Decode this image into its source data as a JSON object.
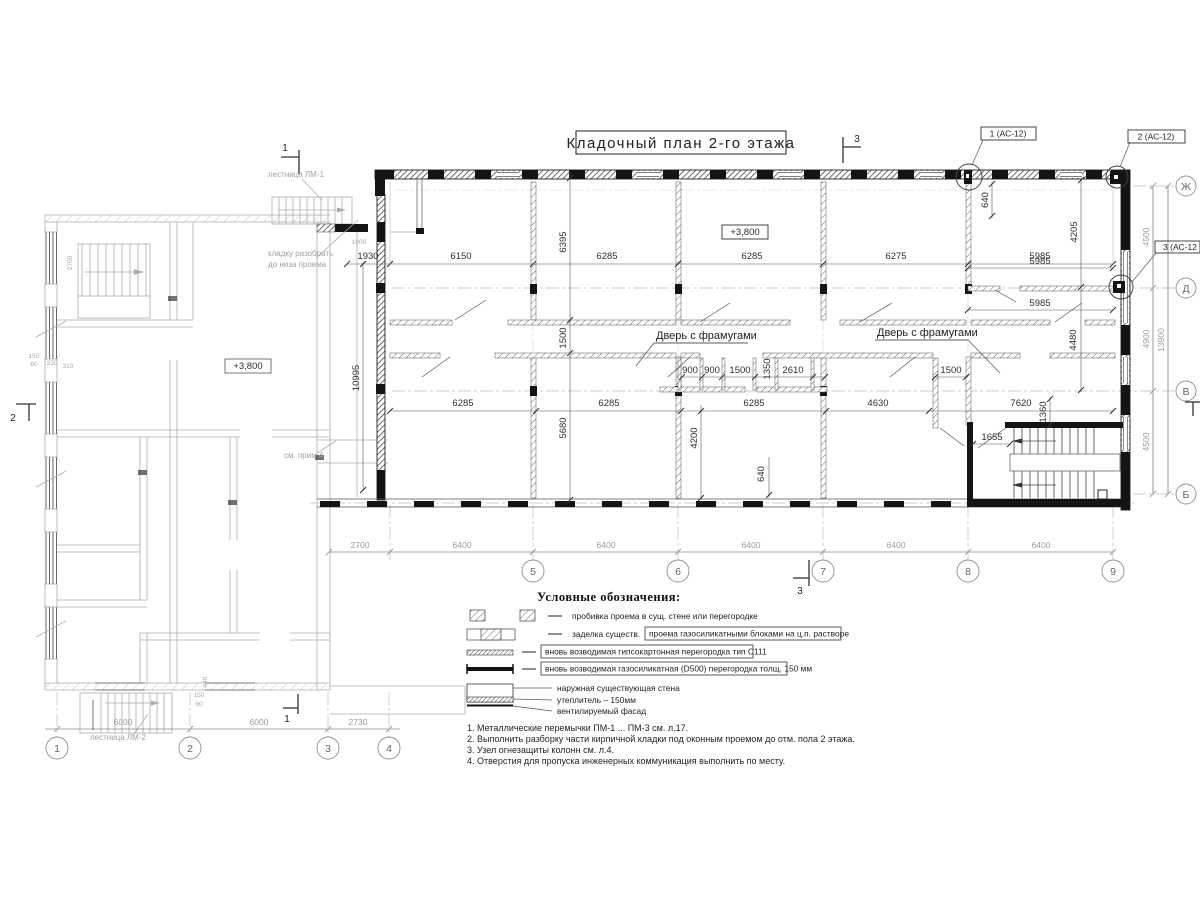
{
  "title": "Кладочный план 2-го этажа",
  "elevation_main": "+3,800",
  "elevation_left": "+3,800",
  "callouts": {
    "c1": "1 (АС-12)",
    "c2": "2 (АС-12)",
    "c3": "3 (АС-12"
  },
  "section_markers": {
    "top3": "3",
    "bottom3": "3",
    "top1": "1",
    "bottom1": "1",
    "left2": "2"
  },
  "axis": {
    "right": [
      "Ж",
      "Д",
      "В",
      "Б"
    ],
    "bottom_main": [
      "5",
      "6",
      "7",
      "8",
      "9"
    ],
    "bottom_left": [
      "1",
      "2",
      "3",
      "4"
    ]
  },
  "labels": {
    "door1": "Дверь с фрамугами",
    "door2": "Дверь с фрамугами",
    "stair_top": "лестница ЛМ-1",
    "stair_bottom": "лестница ЛМ-2",
    "demolish1": "кладку разобрать",
    "demolish2": "до низа проема",
    "see_note": "см. прим 4"
  },
  "dims": {
    "row_top": [
      "1930",
      "6150",
      "6285",
      "6285",
      "6275",
      "5985"
    ],
    "row_mid": [
      "6285",
      "6285",
      "6285",
      "4630",
      "7620"
    ],
    "row_small": [
      "900",
      "900",
      "1500",
      "1350",
      "2610"
    ],
    "v10995": "10995",
    "v6395": "6395",
    "v1500": "1500",
    "v5680": "5680",
    "v4200": "4200",
    "lead640a": "640",
    "lead640b": "640",
    "v4205": "4205",
    "v4480": "4480",
    "h5985a": "5985",
    "h5985b": "5985",
    "door1500": "1500",
    "d1655": "1655",
    "v1360": "1360",
    "axis_main": [
      "2700",
      "6400",
      "6400",
      "6400",
      "6400",
      "6400"
    ],
    "axis_left": [
      "6000",
      "6000",
      "2730"
    ],
    "right_col": [
      "4500",
      "4900",
      "4500",
      "13900"
    ],
    "tiny": [
      "2750",
      "150",
      "60",
      "230",
      "310",
      "1000",
      "150",
      "90",
      "440"
    ]
  },
  "legend": {
    "heading": "Условные обозначения:",
    "item1": "пробивка проема  в сущ. стене  или перегородке",
    "item2_plain": "заделка существ.",
    "item2_boxed": "проема газосиликатными блоками на ц.п. растворе",
    "item3_boxed": "вновь возводимая гипсокартонная перегородка тип С111",
    "item4_boxed": "вновь возводимая газосиликатная (D500) перегородка толщ. 150 мм",
    "wall1": "наружная существующая стена",
    "wall2": "утеплитель – 150мм",
    "wall3": "вентилируемый фасад"
  },
  "notes": [
    "1. Металлические перемычки  ПМ-1 ... ПМ-3 см. л.17.",
    "2. Выполнить разборку части кирпичной кладки под оконным проемом до отм. пола 2 этажа.",
    "3. Узел огнезащиты колонн см. л.4.",
    "4. Отверстия для пропуска инженерных коммуникация выполнить по месту."
  ]
}
